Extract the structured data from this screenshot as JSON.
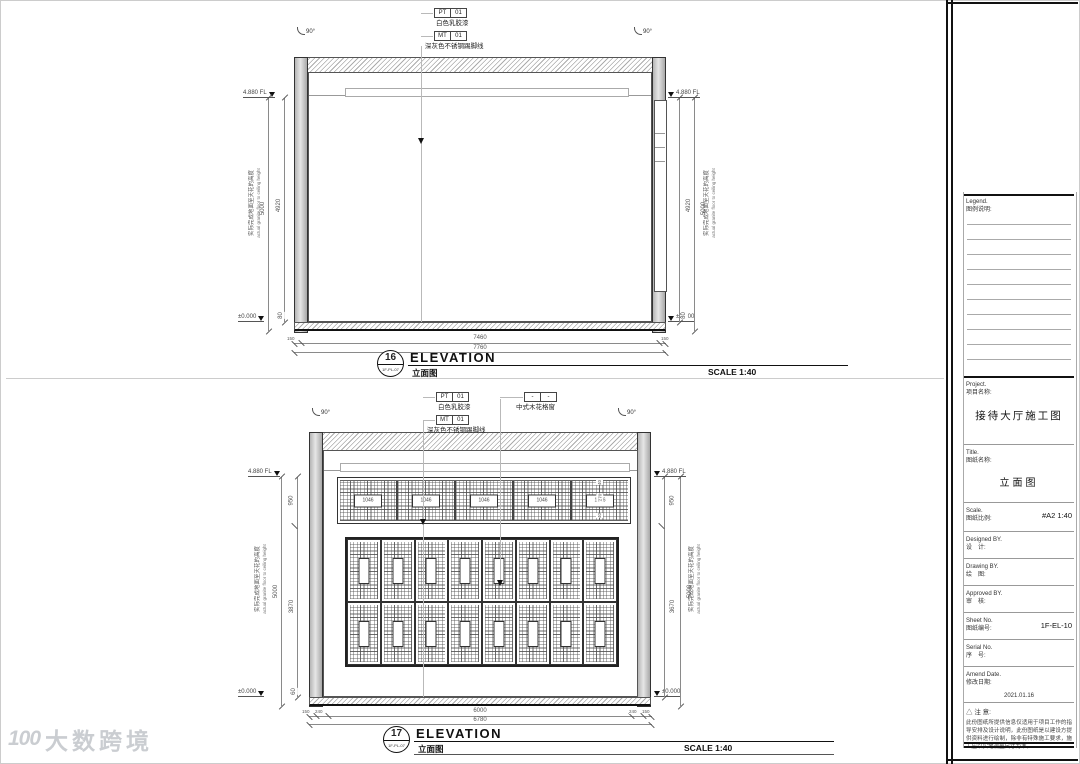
{
  "wm": {
    "logo": "100",
    "text": "大数跨境"
  },
  "e16": {
    "num": "16",
    "ref": "1F-PL-07",
    "title": "ELEVATION",
    "title_cn": "立面图",
    "scale": "SCALE 1:40",
    "pt_tag": "PT",
    "pt_code": "01",
    "pt_desc": "白色乳胶漆",
    "mt_tag": "MT",
    "mt_code": "01",
    "mt_desc": "深灰色不锈钢踢脚线",
    "angle": "90°",
    "lvl_top": "4.880 FL",
    "lvl_bot": "±0.000",
    "h_inner": "4920",
    "h_floor": "80",
    "h_total": "5000",
    "note_cn": "实际完成地面至天花的高度",
    "note_en": "actual granite floor to ceiling height",
    "b_left": "150",
    "b_mid": "7460",
    "b_right": "150",
    "b_total": "7760"
  },
  "e17": {
    "num": "17",
    "ref": "1F-PL-07",
    "title": "ELEVATION",
    "title_cn": "立面图",
    "scale": "SCALE 1:40",
    "pt_tag": "PT",
    "pt_code": "01",
    "pt_desc": "白色乳胶漆",
    "mt_tag": "MT",
    "mt_code": "01",
    "mt_desc": "深灰色不锈钢踢脚线",
    "wd_tag": "-",
    "wd_code": "-",
    "wd_desc": "中式木花格窗",
    "angle": "90°",
    "lvl_top": "4.880 FL",
    "lvl_bot": "±0.000",
    "h_top": "950",
    "h_left": "3870",
    "h_right": "3670",
    "h_floor": "60",
    "h_total": "5000",
    "note_cn": "实际完成地面至天花的高度",
    "note_en": "actual granite floor to ceiling height",
    "frieze": [
      "1046",
      "1046",
      "1046",
      "1046",
      "1046"
    ],
    "f40": "40",
    "f270": "270",
    "b1": "150",
    "b2": "240",
    "b_mid": "6000",
    "b4": "240",
    "b5": "150",
    "b_total": "6780"
  },
  "tb": {
    "legend_en": "Legend.",
    "legend_cn": "图例说明:",
    "project_en": "Project.",
    "project_cn": "项目名称:",
    "project": "接待大厅施工图",
    "title_en": "Title.",
    "title_cn": "图纸名称:",
    "title": "立面图",
    "scale_en": "Scale.",
    "scale_cn": "图纸比例:",
    "scale": "#A2  1:40",
    "designed_en": "Designed BY.",
    "designed_cn": "设　计:",
    "drawing_en": "Drawing BY.",
    "drawing_cn": "绘　图:",
    "approved_en": "Approved BY.",
    "approved_cn": "审　核:",
    "sheet_en": "Sheet No.",
    "sheet_cn": "图纸编号:",
    "sheet": "1F-EL-10",
    "serial_en": "Serial No.",
    "serial_cn": "序　号:",
    "amend_en": "Amend Date.",
    "amend_cn": "修改日期:",
    "amend": "2021.01.16",
    "note_mark": "△",
    "note_title": "注 意:",
    "note": "此份图纸所提供信息仅适用于项目工作的指导安排及设计说明，此份图纸是以建设方提供资料进行绘制，除非有特殊施工要求，施工应以实地测量尺寸为准。"
  }
}
